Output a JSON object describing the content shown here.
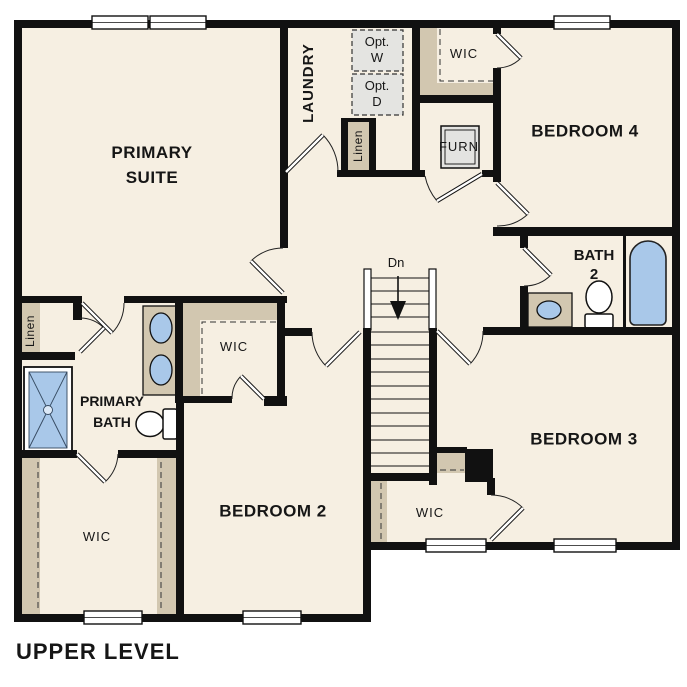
{
  "caption": "UPPER LEVEL",
  "labels": {
    "primary_suite": {
      "line1": "PRIMARY",
      "line2": "SUITE"
    },
    "laundry": "LAUNDRY",
    "opt_w": {
      "line1": "Opt.",
      "line2": "W"
    },
    "opt_d": {
      "line1": "Opt.",
      "line2": "D"
    },
    "wic_top": "WIC",
    "bedroom4": "BEDROOM 4",
    "furn": "FURN",
    "linen_top": "Linen",
    "bath2": {
      "line1": "BATH",
      "line2": "2"
    },
    "stairs": "Dn",
    "wic_mid": "WIC",
    "primary_bath": {
      "line1": "PRIMARY",
      "line2": "BATH"
    },
    "linen_left": "Linen",
    "wic_bottom_left": "WIC",
    "bedroom2": "BEDROOM 2",
    "wic_bottom_mid": "WIC",
    "bedroom3": "BEDROOM 3"
  },
  "colors": {
    "floor": "#f6efe2",
    "wall": "#111111",
    "shelf_tan": "#d2c7b0",
    "fixture_blue": "#a9c8e9",
    "optional_gray": "#e4e4e1",
    "window_white": "#ffffff"
  },
  "fixtures": [
    "stairs-down",
    "shower",
    "bathtub",
    "toilet-primary-bath",
    "toilet-bath2",
    "double-vanity-sinks",
    "bath2-vanity-sink",
    "furnace-unit",
    "optional-washer",
    "optional-dryer"
  ]
}
